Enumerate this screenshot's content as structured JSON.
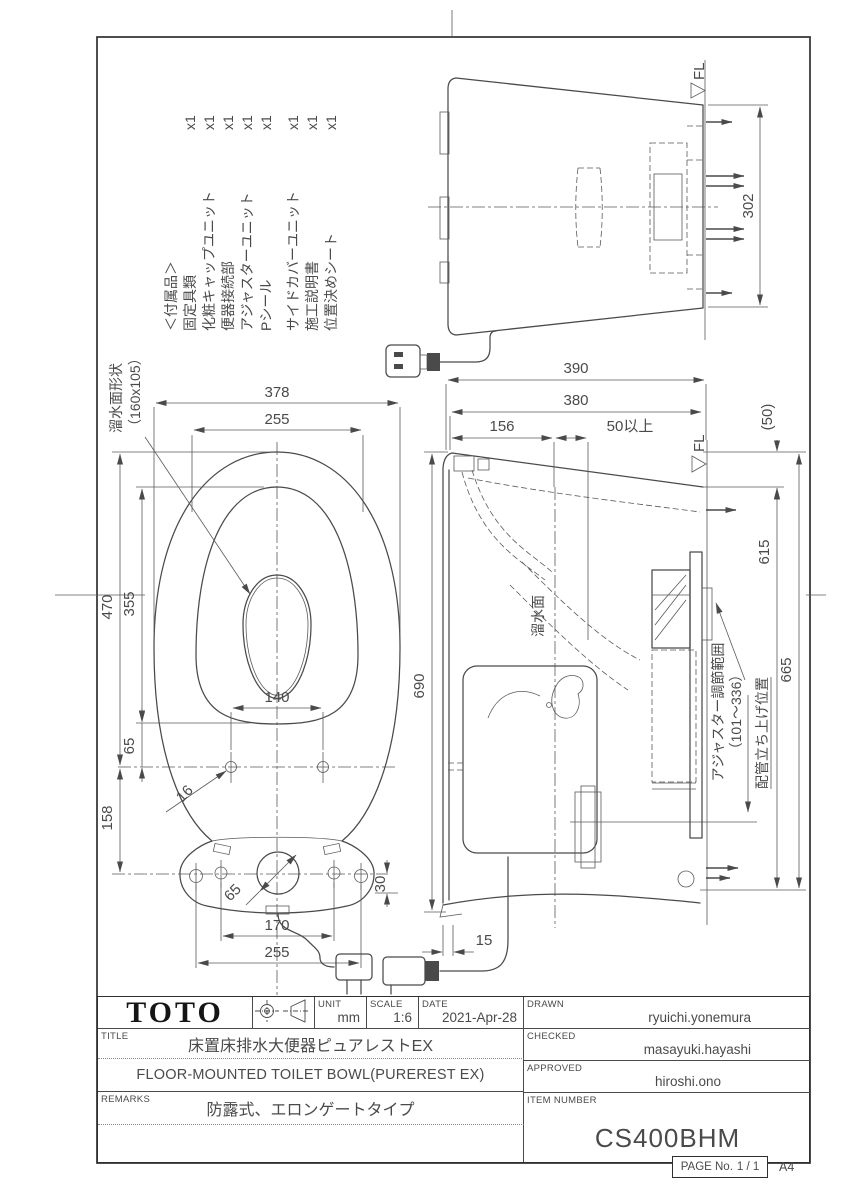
{
  "sheet": {
    "paper_size": "A4"
  },
  "accessories": {
    "header": "＜付属品＞",
    "items": [
      {
        "name": "固定具類",
        "qty": "x1"
      },
      {
        "name": "化粧キャップユニット",
        "qty": "x1"
      },
      {
        "name": "便器接続部",
        "qty": "x1"
      },
      {
        "name": "アジャスターユニット",
        "qty": "x1"
      },
      {
        "name": "Pシール",
        "qty": "x1"
      },
      {
        "name": "サイドカバーユニット",
        "qty": "x1"
      },
      {
        "name": "施工説明書",
        "qty": "x1"
      },
      {
        "name": "位置決めシート",
        "qty": "x1"
      }
    ]
  },
  "rear_view": {
    "dim_floor_width": "302",
    "floor_label": "FL"
  },
  "plan_view": {
    "water_shape_label": "溜水面形状",
    "water_shape_size": "（160x105）",
    "dim_overall_width": "378",
    "dim_rim_width": "255",
    "dim_overall_length": "470",
    "dim_inner_length": "355",
    "dim_seat_bolt_span": "140",
    "dim_bolt_offset": "65",
    "dim_bolt_to_base": "158",
    "dim_seat_bolt_dia": "16",
    "dim_drain_dia": "65",
    "dim_base_edge": "30",
    "dim_base_bolt_span": "170",
    "dim_base_width": "255"
  },
  "side_view": {
    "floor_label": "FL",
    "dim_height_total": "390",
    "dim_height_rim": "380",
    "dim_head": "156",
    "dim_clearance": "50以上",
    "dim_paren50": "(50)",
    "dim_615": "615",
    "dim_665": "665",
    "dim_depth_total": "690",
    "dim_front_gap": "15",
    "water_line_label": "溜水面",
    "adjuster_label": "アジャスター調節範囲",
    "adjuster_range": "（101～336）",
    "pipe_position_label": "配管立ち上げ位置"
  },
  "title_block": {
    "logo": "TOTO",
    "unit_label": "UNIT",
    "unit_value": "mm",
    "scale_label": "SCALE",
    "scale_value": "1:6",
    "date_label": "DATE",
    "date_value": "2021-Apr-28",
    "title_label": "TITLE",
    "title_ja": "床置床排水大便器ピュアレストEX",
    "title_en": "FLOOR-MOUNTED TOILET BOWL(PUREREST EX)",
    "remarks_label": "REMARKS",
    "remarks_value": "防露式、エロンゲートタイプ",
    "drawn_label": "DRAWN",
    "drawn_value": "ryuichi.yonemura",
    "checked_label": "CHECKED",
    "checked_value": "masayuki.hayashi",
    "approved_label": "APPROVED",
    "approved_value": "hiroshi.ono",
    "item_label": "ITEM NUMBER",
    "item_value": "CS400BHM",
    "page_label": "PAGE No.",
    "page_value": "1 / 1",
    "paper_size": "A4"
  },
  "colors": {
    "line": "#4a4a4a",
    "frame": "#2f2f2f",
    "text": "#4a4a4a"
  }
}
